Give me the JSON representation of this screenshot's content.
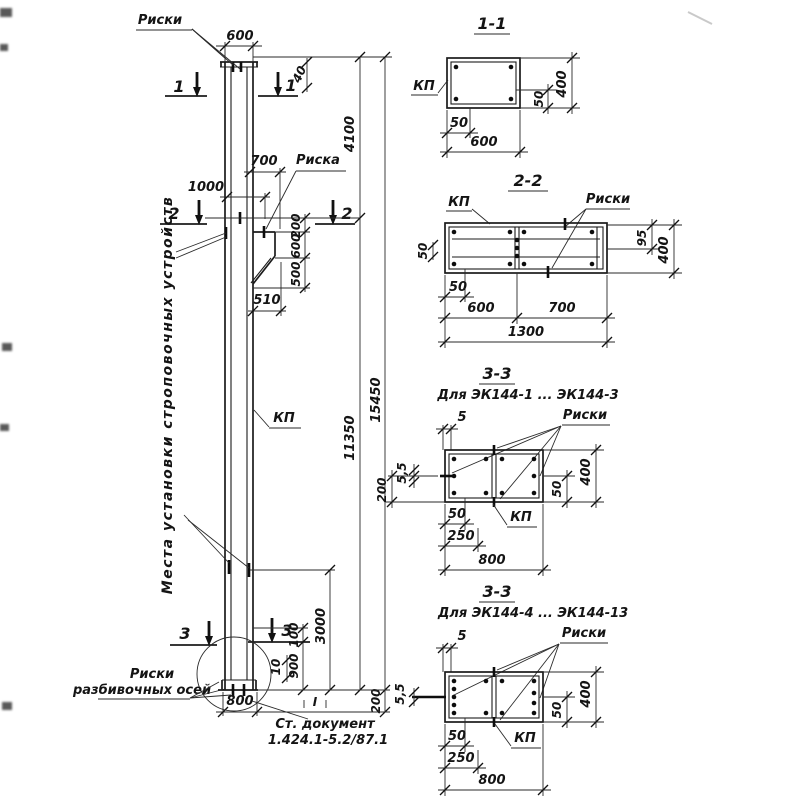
{
  "common": {
    "kp": "КП",
    "riski": "Риски",
    "riska": "Риска"
  },
  "elevation": {
    "cut1": "1",
    "cut2": "2",
    "cut3": "3",
    "dims": {
      "w600": "600",
      "d40": "40",
      "d700": "700",
      "d1000": "1000",
      "c200": "200",
      "c600": "600",
      "c500": "500",
      "d510": "510",
      "h4100": "4100",
      "h11350": "11350",
      "h15450": "15450",
      "h3000": "3000",
      "d100": "100",
      "d900": "900",
      "d10": "10",
      "w800": "800",
      "b200": "200"
    },
    "strop_note": "Места установки строповочных устройств",
    "axis_note1": "Риски",
    "axis_note2": "разбивочных осей",
    "doc1": "Ст. документ",
    "doc2": "1.424.1-5.2/87.1",
    "mark": "I"
  },
  "section11": {
    "title": "1-1",
    "d50b": "50",
    "d600": "600",
    "d50r": "50",
    "d400": "400"
  },
  "section22": {
    "title": "2-2",
    "d50l": "50",
    "d50b": "50",
    "d600": "600",
    "d700": "700",
    "d1300": "1300",
    "d95": "95",
    "d400": "400"
  },
  "section33a": {
    "title": "3-3",
    "subtitle": "Для ЭК144-1 ... ЭК144-3",
    "d5": "5",
    "d55": "5,5",
    "d200": "200",
    "d50b": "50",
    "d250": "250",
    "d800": "800",
    "d50r": "50",
    "d400": "400"
  },
  "section33b": {
    "title": "3-3",
    "subtitle": "Для ЭК144-4 ... ЭК144-13",
    "d5": "5",
    "d55": "5,5",
    "d50b": "50",
    "d250": "250",
    "d800": "800",
    "d50r": "50",
    "d400": "400"
  }
}
